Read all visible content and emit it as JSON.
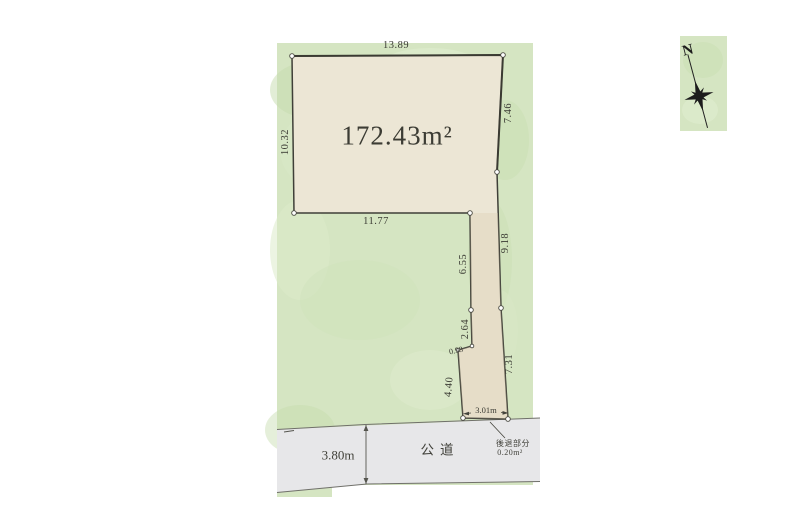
{
  "plan": {
    "area_label": "172.43m²",
    "dims": {
      "top": "13.89",
      "left": "10.32",
      "right_upper": "7.46",
      "right_mid": "9.18",
      "right_lower": "7.31",
      "bottom": "11.77",
      "flag_left_upper": "6.55",
      "flag_left_mid": "2.64",
      "flag_jog": "0.98",
      "flag_left_lower": "4.40",
      "flag_bottom": "3.01m"
    },
    "road": {
      "label": "公道",
      "width_label": "3.80m"
    },
    "setback": {
      "name": "後退部分",
      "area": "0.20m²"
    },
    "compass": {
      "north": "N"
    }
  },
  "colors": {
    "background": "#ffffff",
    "green_area": "#d5e5c2",
    "parcel_fill": "#ece6d5",
    "flag_strip_tint": "#d8c9ad",
    "road_fill": "#e7e7e9",
    "outline": "#3f3f38",
    "text": "#3a3a33"
  }
}
